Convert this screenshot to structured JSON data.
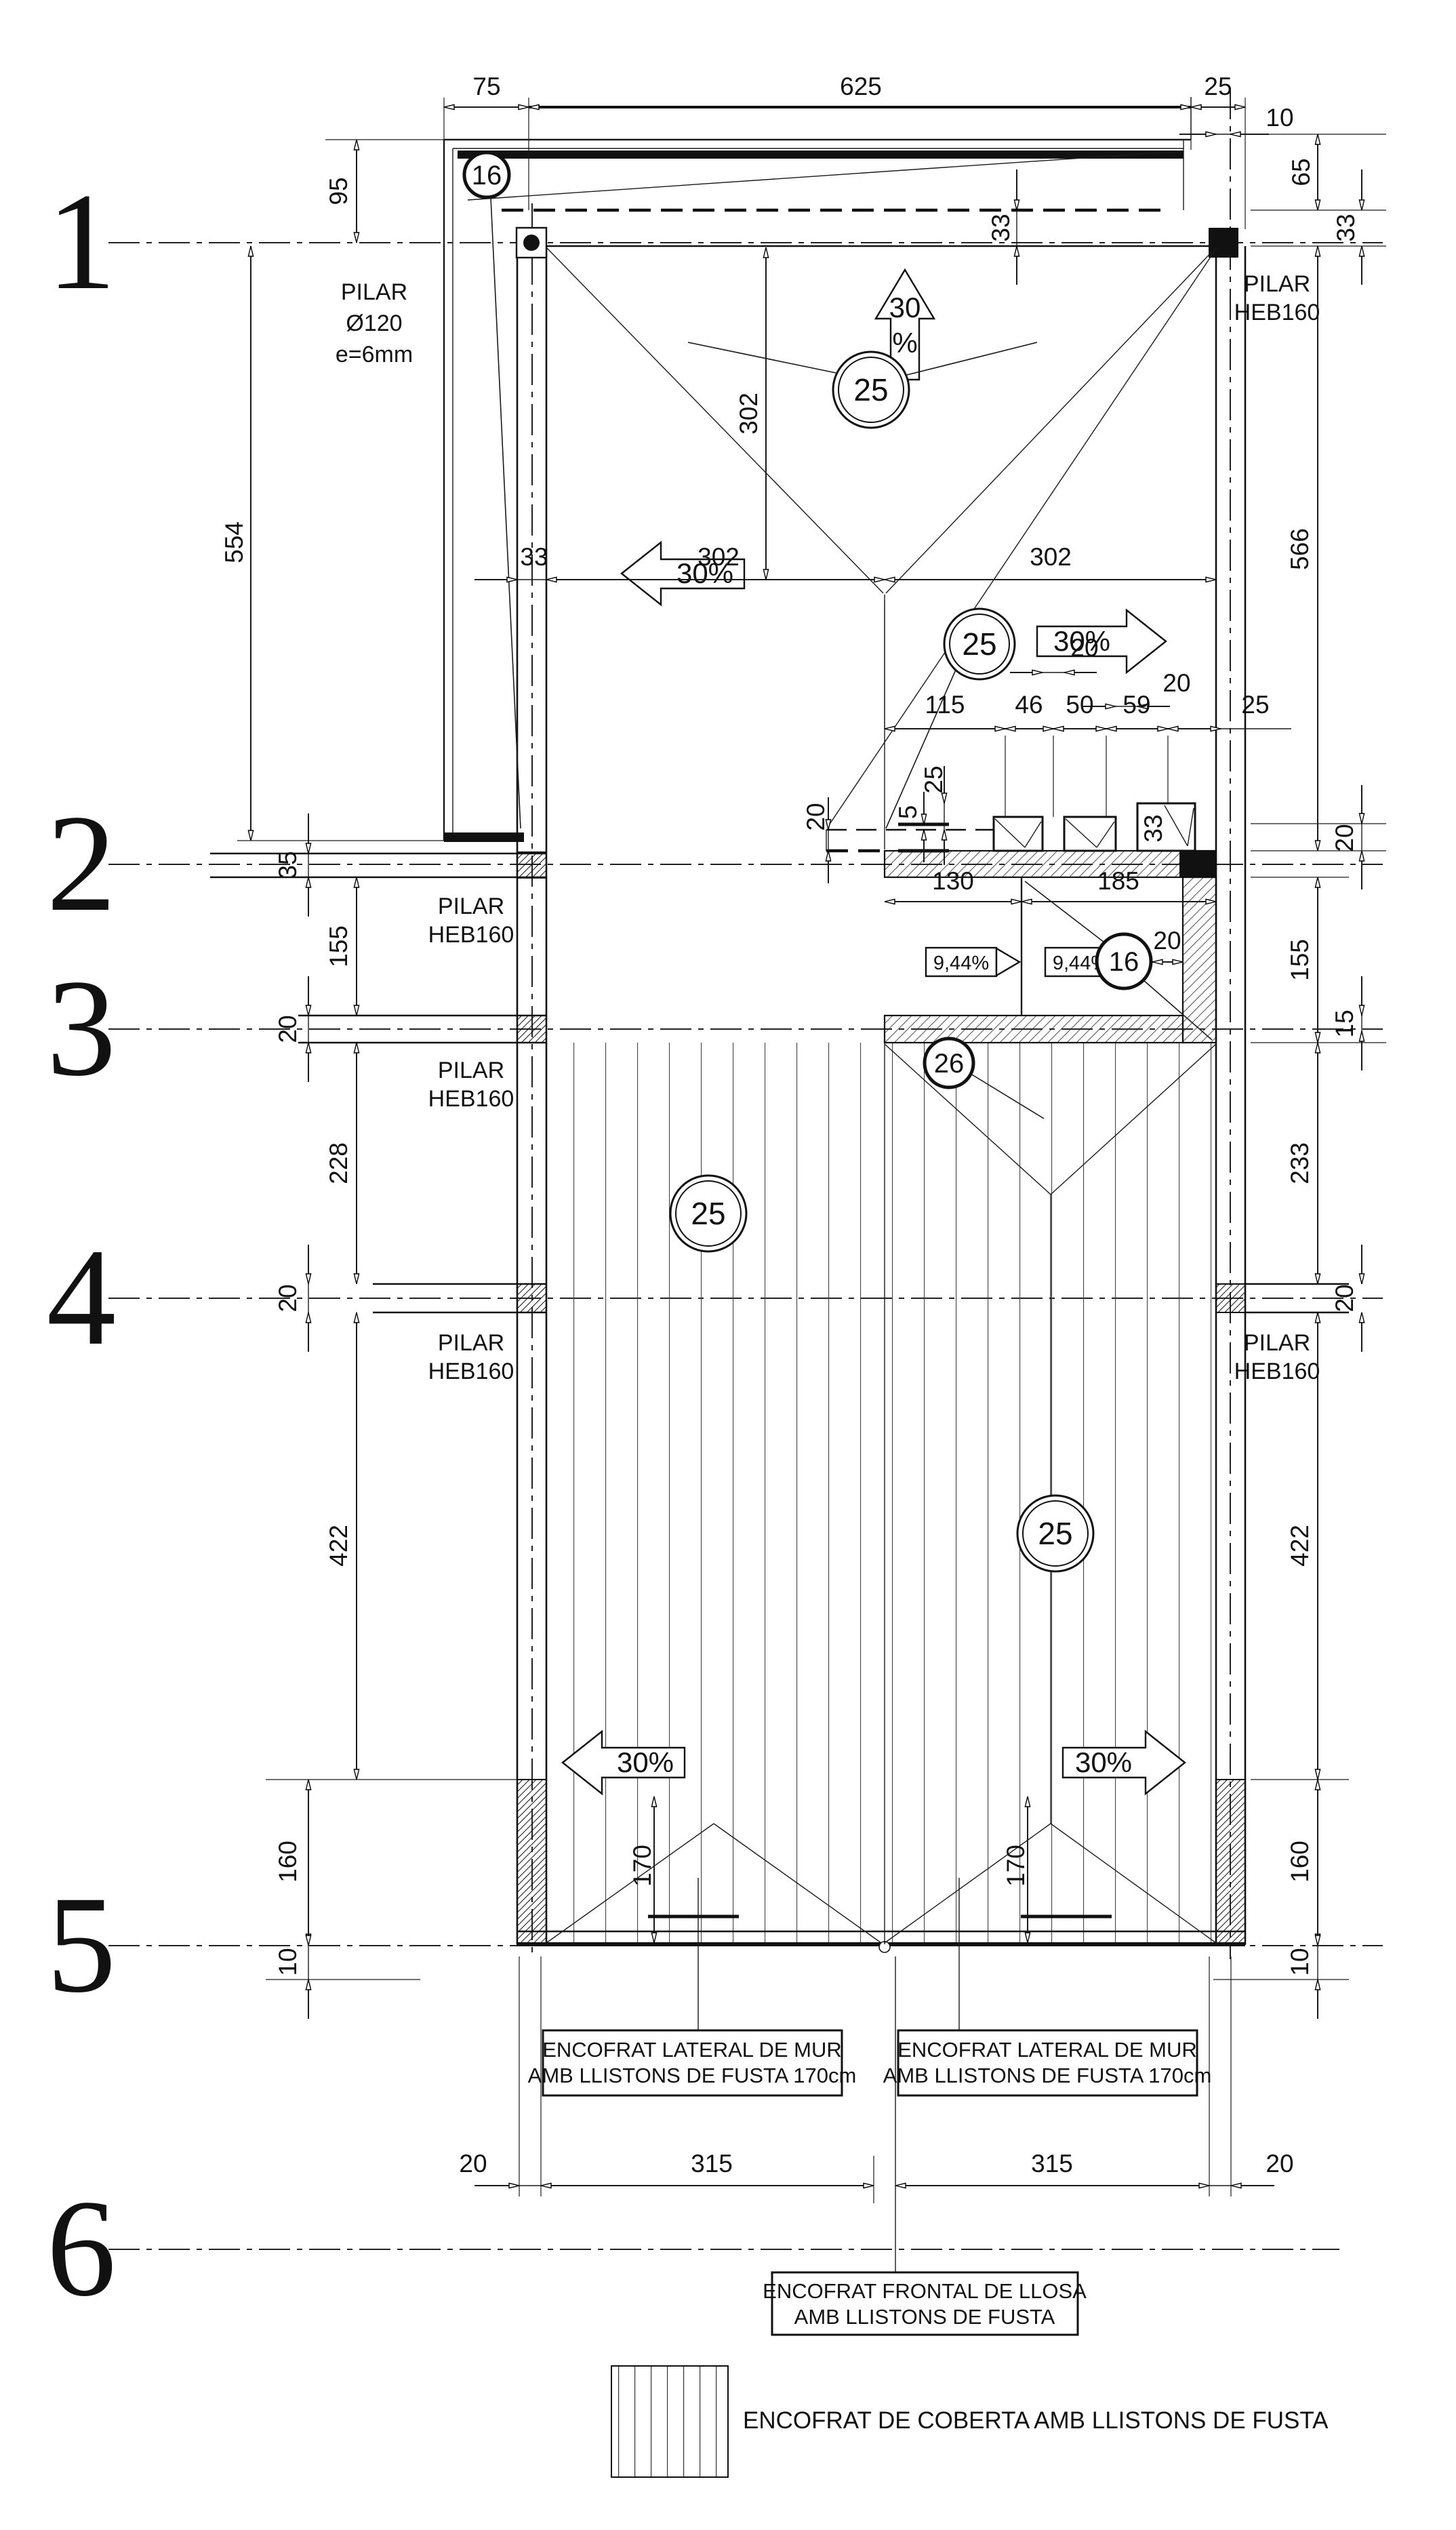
{
  "grid_numbers": [
    "1",
    "2",
    "3",
    "4",
    "5",
    "6"
  ],
  "dims": {
    "top75": "75",
    "top625": "625",
    "top25": "25",
    "top10": "10",
    "l95": "95",
    "l554": "554",
    "l35": "35",
    "l155": "155",
    "l20a": "20",
    "l228": "228",
    "l20b": "20",
    "l422": "422",
    "l160": "160",
    "l10": "10",
    "r65": "65",
    "r33a": "33",
    "r33b": "33",
    "r566": "566",
    "r20a": "20",
    "r155": "155",
    "r15": "15",
    "r233": "233",
    "r20b": "20",
    "r422": "422",
    "r160": "160",
    "r10": "10",
    "v302": "302",
    "w33": "33",
    "h302a": "302",
    "h302b": "302",
    "c115": "115",
    "c46": "46",
    "c50": "50",
    "c59": "59",
    "c25": "25",
    "c20a": "20",
    "c20b": "20",
    "c25v": "25",
    "c5v": "5",
    "c20v": "20",
    "sq33": "33",
    "rm130": "130",
    "rm185": "185",
    "rm20": "20",
    "t170a": "170",
    "t170b": "170",
    "b20a": "20",
    "b315a": "315",
    "b315b": "315",
    "b20b": "20"
  },
  "slopes": {
    "up30": "30",
    "up_pct": "%",
    "left30a": "30%",
    "right30a": "30%",
    "left30b": "30%",
    "right30b": "30%",
    "ramp_a": "9,44%",
    "ramp_b": "9,44%"
  },
  "markers": {
    "c16a": "16",
    "c16b": "16",
    "c25a": "25",
    "c25b": "25",
    "c25c": "25",
    "c25d": "25",
    "c26": "26"
  },
  "texts": {
    "pilar": "PILAR",
    "pilar_d": "Ø120",
    "pilar_e": "e=6mm",
    "heb": "HEB160",
    "lat1": "ENCOFRAT LATERAL DE MUR",
    "lat2": "AMB LLISTONS DE FUSTA 170cm",
    "fr1": "ENCOFRAT FRONTAL DE LLOSA",
    "fr2": "AMB LLISTONS DE FUSTA",
    "legend": "ENCOFRAT DE COBERTA AMB LLISTONS DE FUSTA"
  }
}
